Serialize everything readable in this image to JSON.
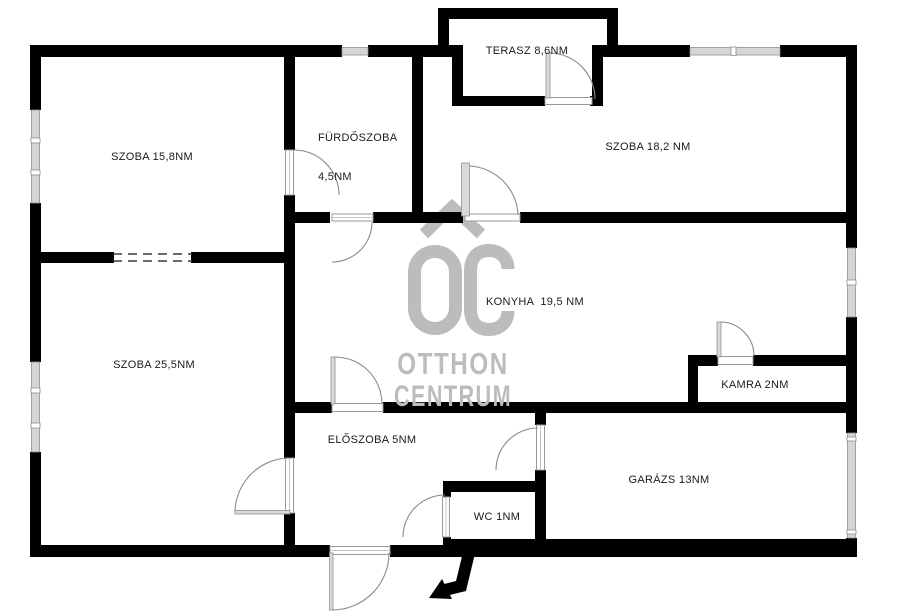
{
  "document_type": "floor-plan",
  "rooms": {
    "szoba15": {
      "label": "SZOBA 15,8NM"
    },
    "furdoszoba": {
      "label_line1": "FÜRDŐSZOBA",
      "label_line2": "4,5NM"
    },
    "terasz": {
      "label": "TERASZ 8,6NM"
    },
    "szoba18": {
      "label": "SZOBA 18,2 NM"
    },
    "konyha": {
      "label": "KONYHA  19,5 NM"
    },
    "szoba25": {
      "label": "SZOBA 25,5NM"
    },
    "kamra": {
      "label": "KAMRA 2NM"
    },
    "eloszoba": {
      "label": "ELŐSZOBA 5NM"
    },
    "garazs": {
      "label": "GARÁZS 13NM"
    },
    "wc": {
      "label": "WC 1NM"
    }
  },
  "watermark": {
    "monogram": "OC",
    "name_line1": "OTTHON",
    "name_line2": "CENTRUM"
  },
  "icons": {
    "entrance_arrow": "bent-arrow-to-entrance-door"
  },
  "colors": {
    "wall": "#000000",
    "window": "#d6d6d6",
    "door_arc": "#8a8a8a",
    "watermark": "#bcbcbc",
    "label_text": "#1a1a1a",
    "background": "#ffffff"
  }
}
